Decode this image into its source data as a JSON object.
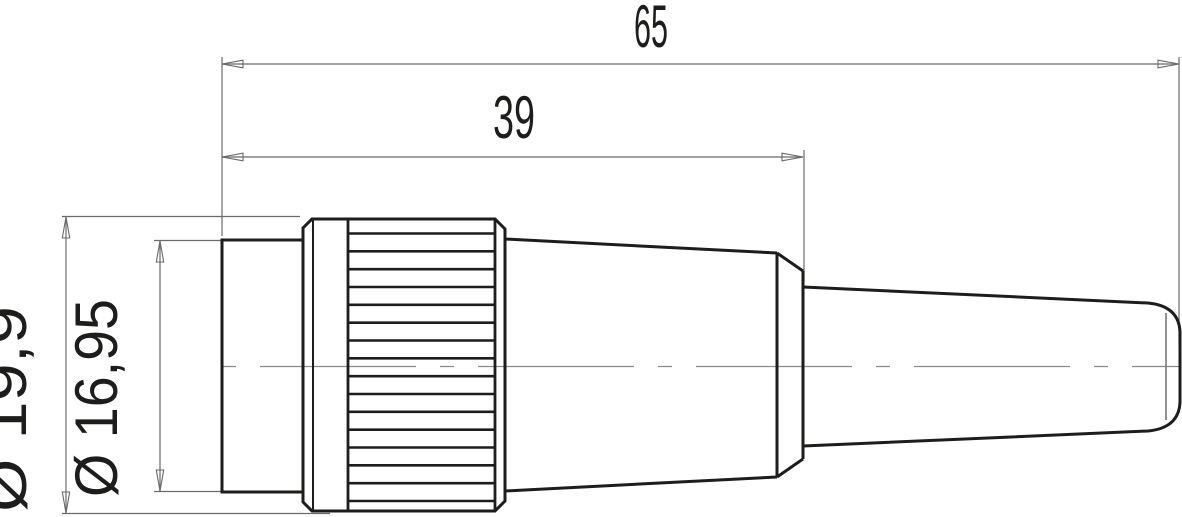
{
  "drawing": {
    "type": "technical-dimension-drawing",
    "view": "side-view-cable-connector",
    "dimensions": {
      "overall_length": "65",
      "front_section_length": "39",
      "body_diameter": "Ø 19,9",
      "mating_face_diameter": "Ø 16,95"
    },
    "colors": {
      "outline": "#1d1d1b",
      "dimension_lines": "#6b6b6b",
      "center_line": "#8c8c8c",
      "background": "#ffffff"
    }
  }
}
